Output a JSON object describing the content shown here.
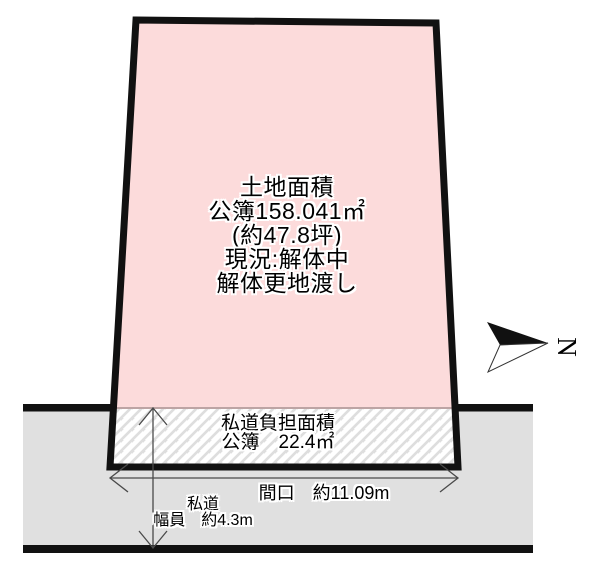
{
  "colors": {
    "plot_fill": "#fcdbdb",
    "road_fill": "#e0e0e0",
    "outline_black": "#111111",
    "dim_line": "#4a4a4a",
    "hatch_line": "#dedede",
    "boundary_line": "#bda4a4"
  },
  "plot": {
    "area_lines": [
      "土地面積",
      "公簿158.041㎡",
      "(約47.8坪)",
      "現況:解体中",
      "解体更地渡し"
    ]
  },
  "private_road_burden": {
    "lines": [
      "私道負担面積",
      "公簿　22.4㎡"
    ]
  },
  "dimensions": {
    "frontage": "間口　約11.09m",
    "road_name": "私道",
    "road_width": "幅員　約4.3m"
  },
  "compass": {
    "north": "N"
  }
}
